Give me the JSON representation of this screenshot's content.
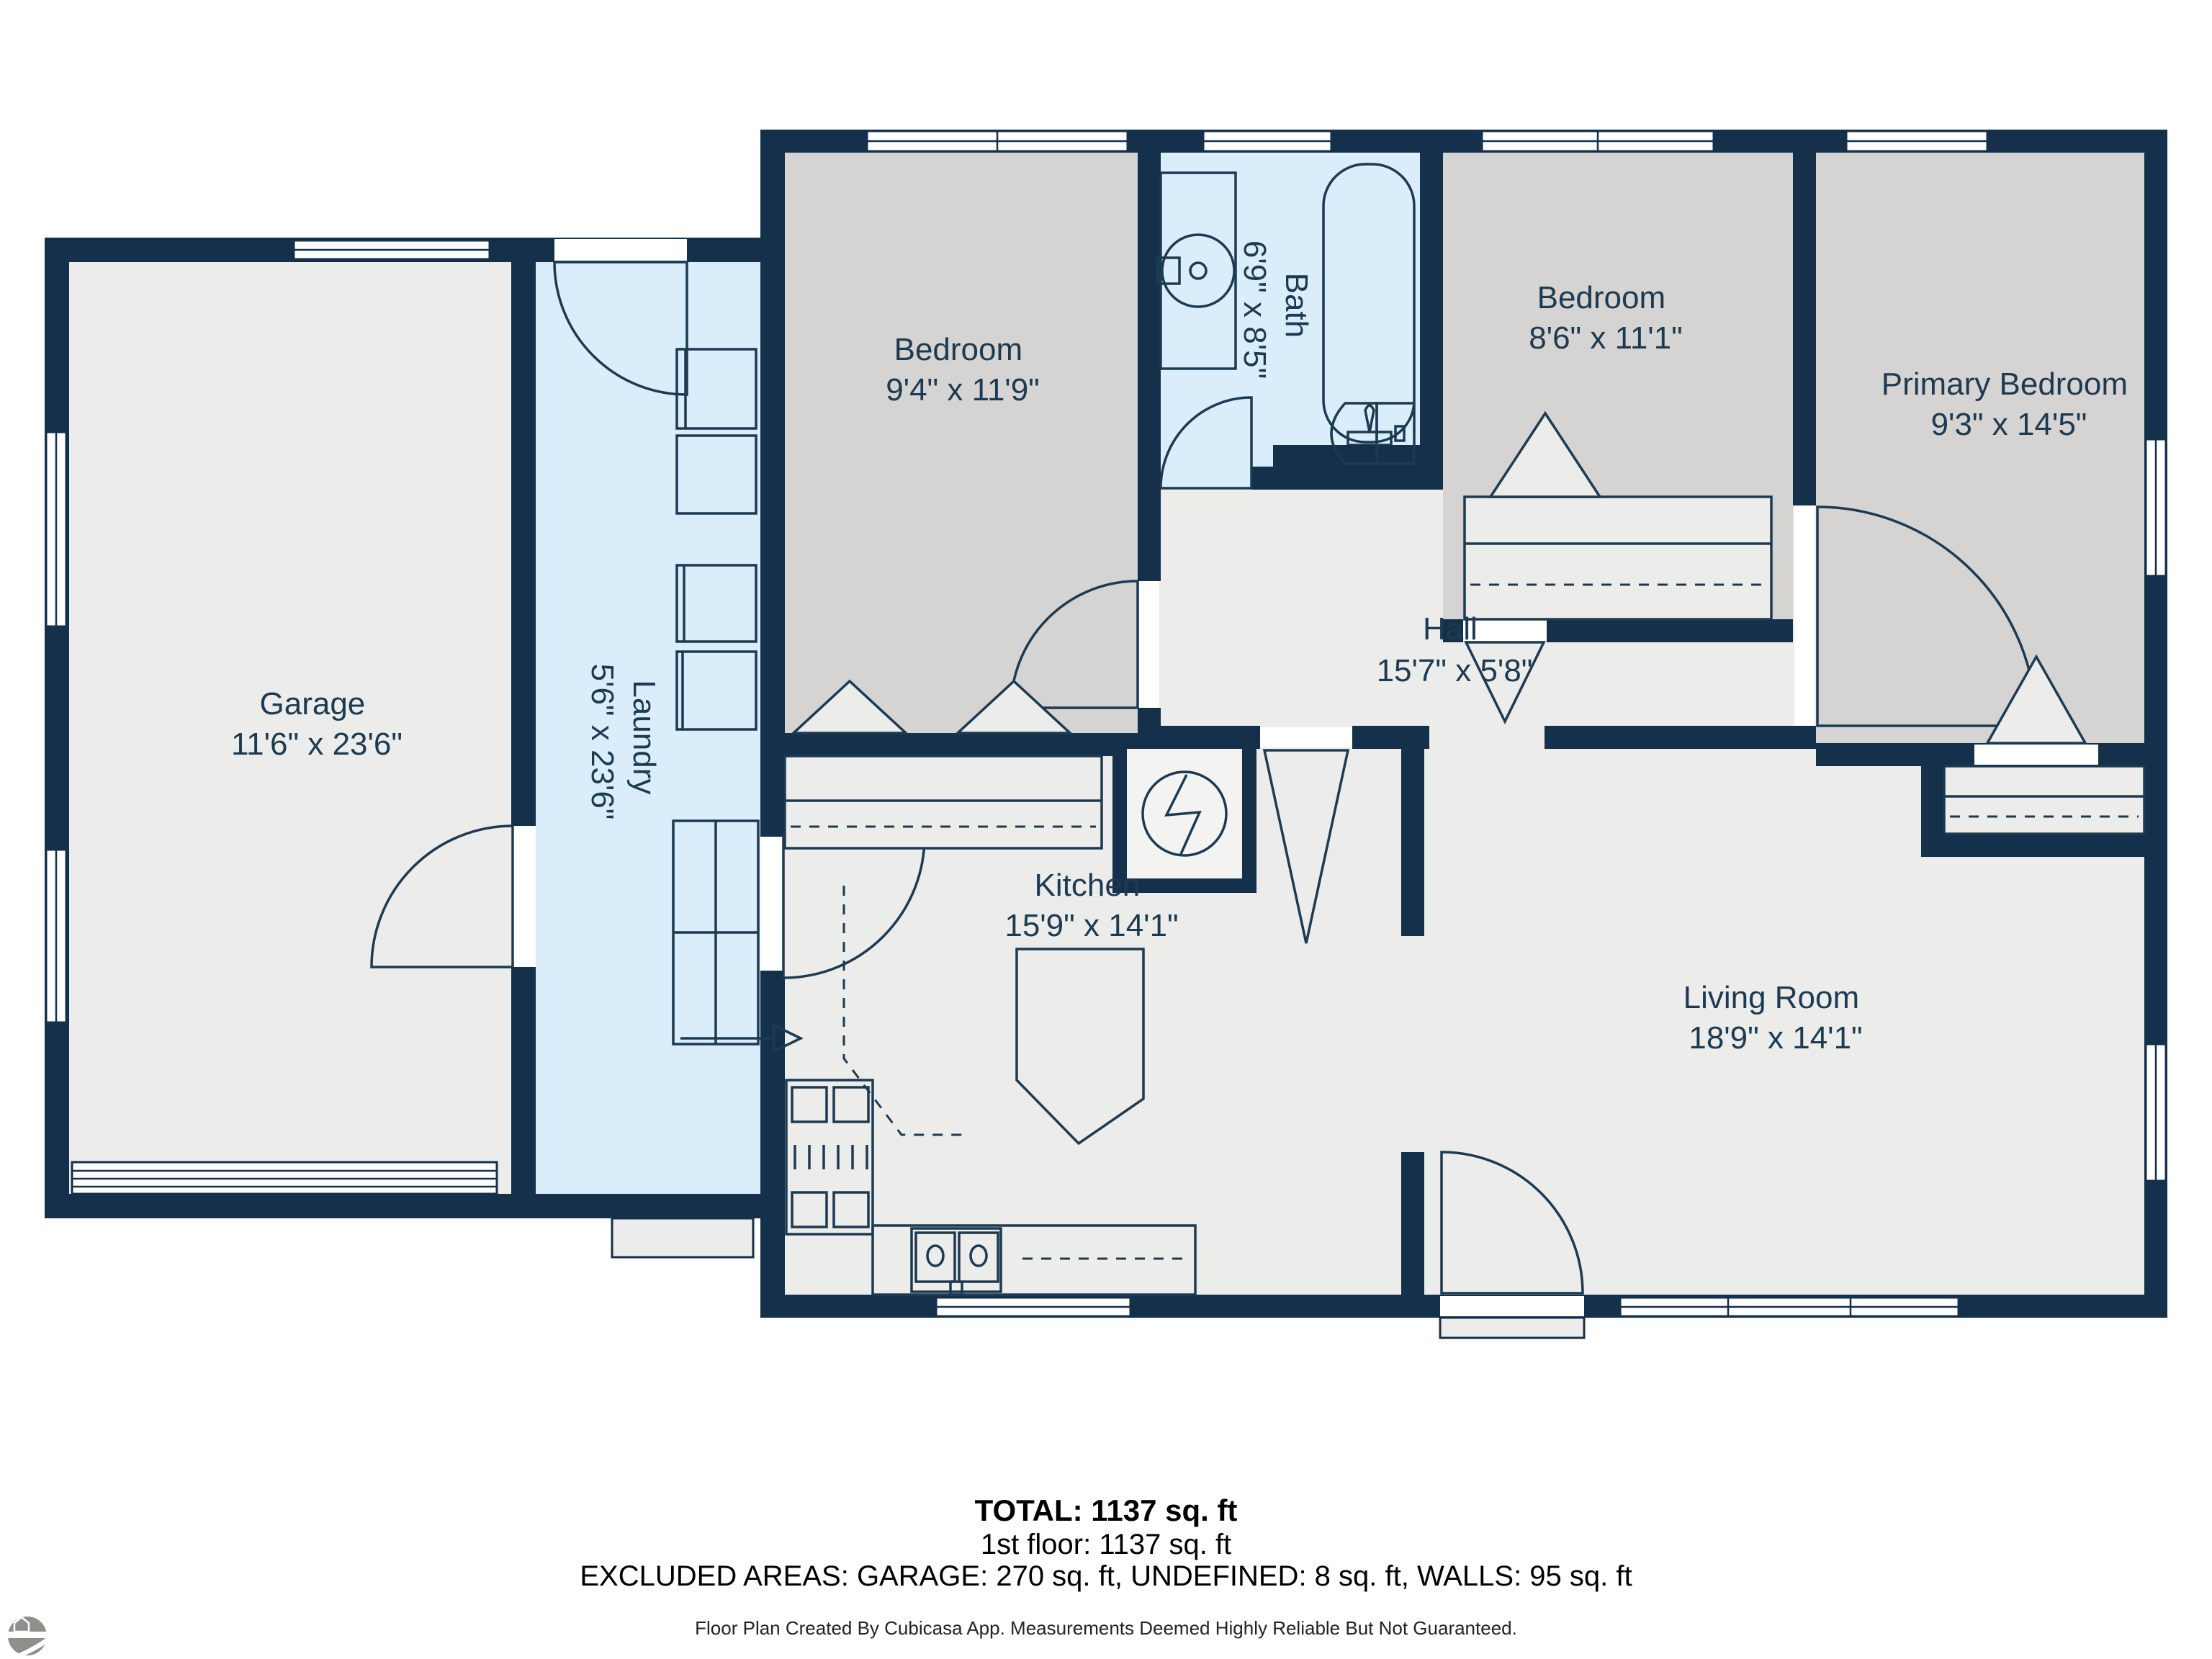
{
  "rooms": [
    {
      "id": "garage",
      "name": "Garage",
      "dims": "11'6\" x 23'6\""
    },
    {
      "id": "laundry",
      "name": "Laundry",
      "dims": "5'6\" x 23'6\""
    },
    {
      "id": "bedroom-1",
      "name": "Bedroom",
      "dims": "9'4\" x 11'9\""
    },
    {
      "id": "bath",
      "name": "Bath",
      "dims": "6'9\" x 8'5\""
    },
    {
      "id": "bedroom-2",
      "name": "Bedroom",
      "dims": "8'6\" x 11'1\""
    },
    {
      "id": "primary-bedroom",
      "name": "Primary Bedroom",
      "dims": "9'3\" x 14'5\""
    },
    {
      "id": "hall",
      "name": "Hall",
      "dims": "15'7\" x 5'8\""
    },
    {
      "id": "kitchen",
      "name": "Kitchen",
      "dims": "15'9\" x 14'1\""
    },
    {
      "id": "living-room",
      "name": "Living Room",
      "dims": "18'9\" x 14'1\""
    }
  ],
  "summary": {
    "total": "TOTAL: 1137 sq. ft",
    "floor": "1st floor: 1137 sq. ft",
    "excluded": "EXCLUDED AREAS: GARAGE: 270 sq. ft, UNDEFINED: 8 sq. ft, WALLS: 95 sq. ft",
    "disclaimer": "Floor Plan Created By Cubicasa App. Measurements Deemed Highly Reliable But Not Guaranteed."
  },
  "colors": {
    "wall_navy": "#14304A",
    "floor_gray_bedroom": "#D5D4D2",
    "floor_light": "#ECECEA",
    "floor_blue_wet": "#D9EDFB",
    "label_navy": "#1C3A52",
    "summary_text": "#000000",
    "logo_gray": "#8F8F8C"
  }
}
